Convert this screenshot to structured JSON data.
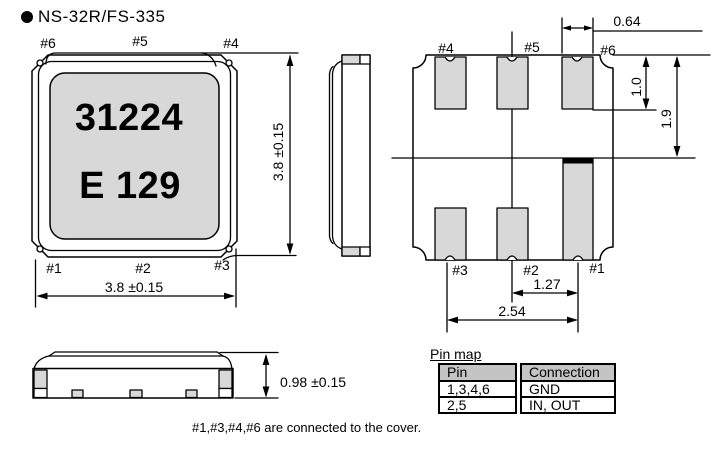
{
  "header": {
    "title": "NS-32R/FS-335"
  },
  "top_view": {
    "pins": {
      "p6": "#6",
      "p5": "#5",
      "p4": "#4",
      "p1": "#1",
      "p2": "#2",
      "p3": "#3"
    },
    "marking1": "31224",
    "marking2": "E 129",
    "dim_height": "3.8 ±0.15",
    "dim_width": "3.8 ±0.15"
  },
  "bottom_view": {
    "pins": {
      "p4": "#4",
      "p5": "#5",
      "p6": "#6",
      "p3": "#3",
      "p2": "#2",
      "p1": "#1"
    },
    "dim_pad_width": "0.64",
    "dim_pad_height": "1.0",
    "dim_half_height": "1.9",
    "dim_pitch_small": "1.27",
    "dim_pitch_large": "2.54"
  },
  "front_view": {
    "dim_height": "0.98 ±0.15"
  },
  "pin_map": {
    "caption": "Pin map",
    "headers": [
      "Pin",
      "Connection"
    ],
    "rows": [
      [
        "1,3,4,6",
        "GND"
      ],
      [
        "2,5",
        "IN, OUT"
      ]
    ]
  },
  "note": "#1,#3,#4,#6 are connected to the cover.",
  "colors": {
    "line": "#000000",
    "pad_fill": "#d8d8d8",
    "table_header_bg": "#c4c4c4",
    "background": "#ffffff"
  }
}
